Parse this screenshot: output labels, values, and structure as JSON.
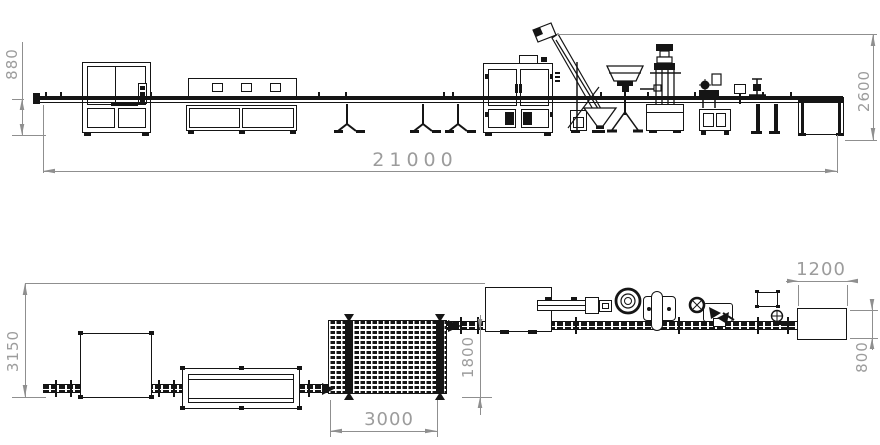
{
  "colors": {
    "machine_line": "#151515",
    "dimension_line": "#8f8f8f",
    "dimension_text": "#9c9c9c",
    "background": "#ffffff"
  },
  "elevation": {
    "dims": {
      "conveyor_height": "880",
      "machine_height": "2600",
      "total_length": "21000"
    }
  },
  "plan": {
    "dims": {
      "line_depth": "3150",
      "conveyor_offset": "1800",
      "accumulator_length": "3000",
      "end_table_length": "1200",
      "end_table_width": "800"
    }
  }
}
